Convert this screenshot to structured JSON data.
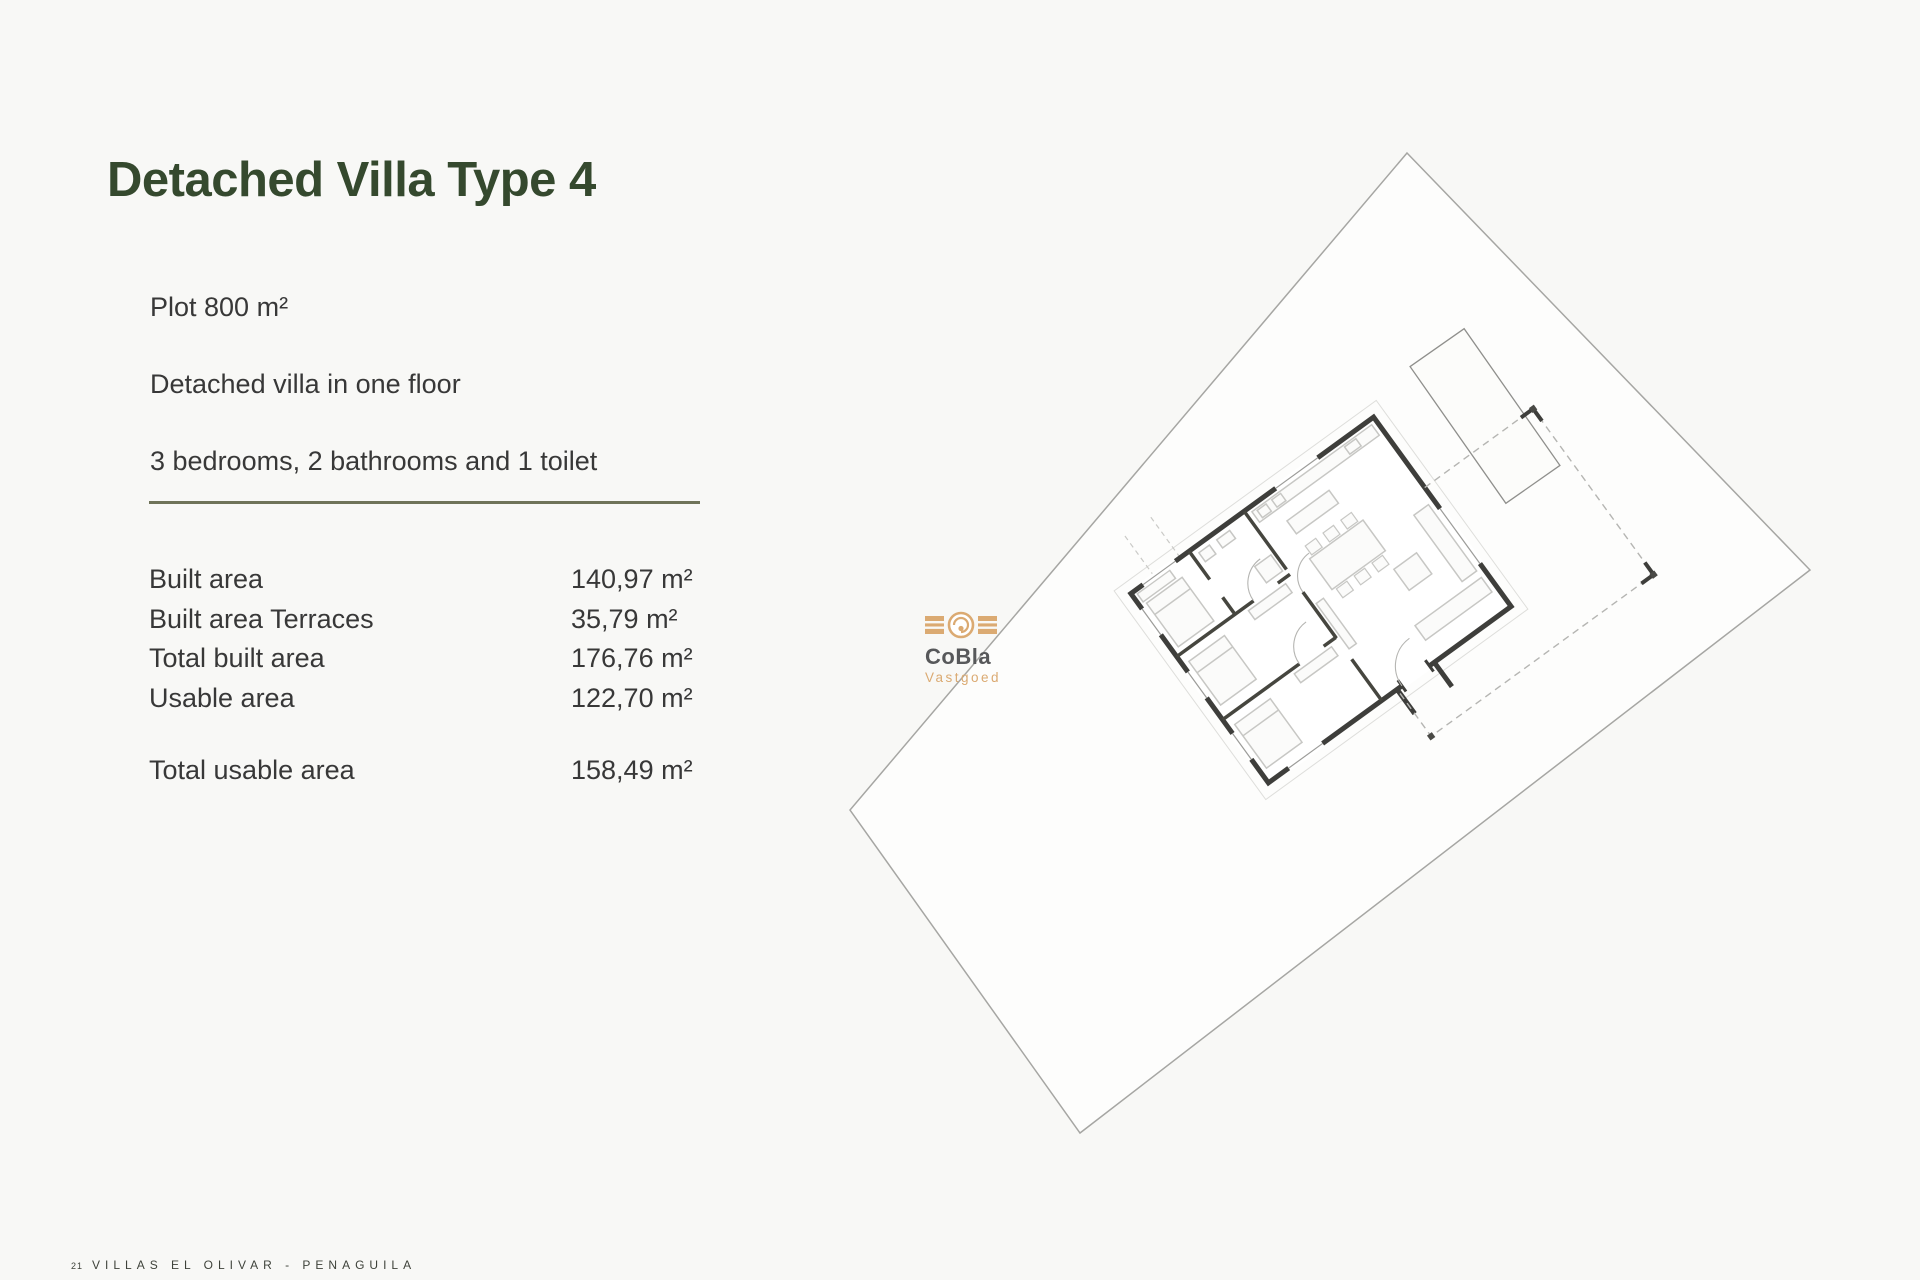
{
  "header": {
    "title": "Detached Villa Type 4"
  },
  "intro": {
    "plot": "Plot 800 m²",
    "floors": "Detached villa in one floor",
    "rooms": "3 bedrooms, 2 bathrooms and 1 toilet"
  },
  "specs": {
    "rows": [
      {
        "label": "Built area",
        "value": "140,97 m²"
      },
      {
        "label": "Built area Terraces",
        "value": "35,79 m²"
      },
      {
        "label": "Total built area",
        "value": "176,76 m²"
      },
      {
        "label": "Usable area",
        "value": "122,70 m²"
      }
    ],
    "total": {
      "label": "Total usable area",
      "value": "158,49 m²"
    }
  },
  "watermark": {
    "brand": "CoBla",
    "subtitle": "Vastgoed",
    "accent_color": "#DBAA72",
    "brand_color": "#57585A"
  },
  "footer": {
    "page_number": "21",
    "project": "VILLAS EL OLIVAR - PENAGUILA"
  },
  "colors": {
    "title_green": "#35492E",
    "rule_olive": "#6F7359",
    "body_text": "#383838",
    "footer_text": "#3E423A",
    "page_background": "#F8F8F6"
  }
}
